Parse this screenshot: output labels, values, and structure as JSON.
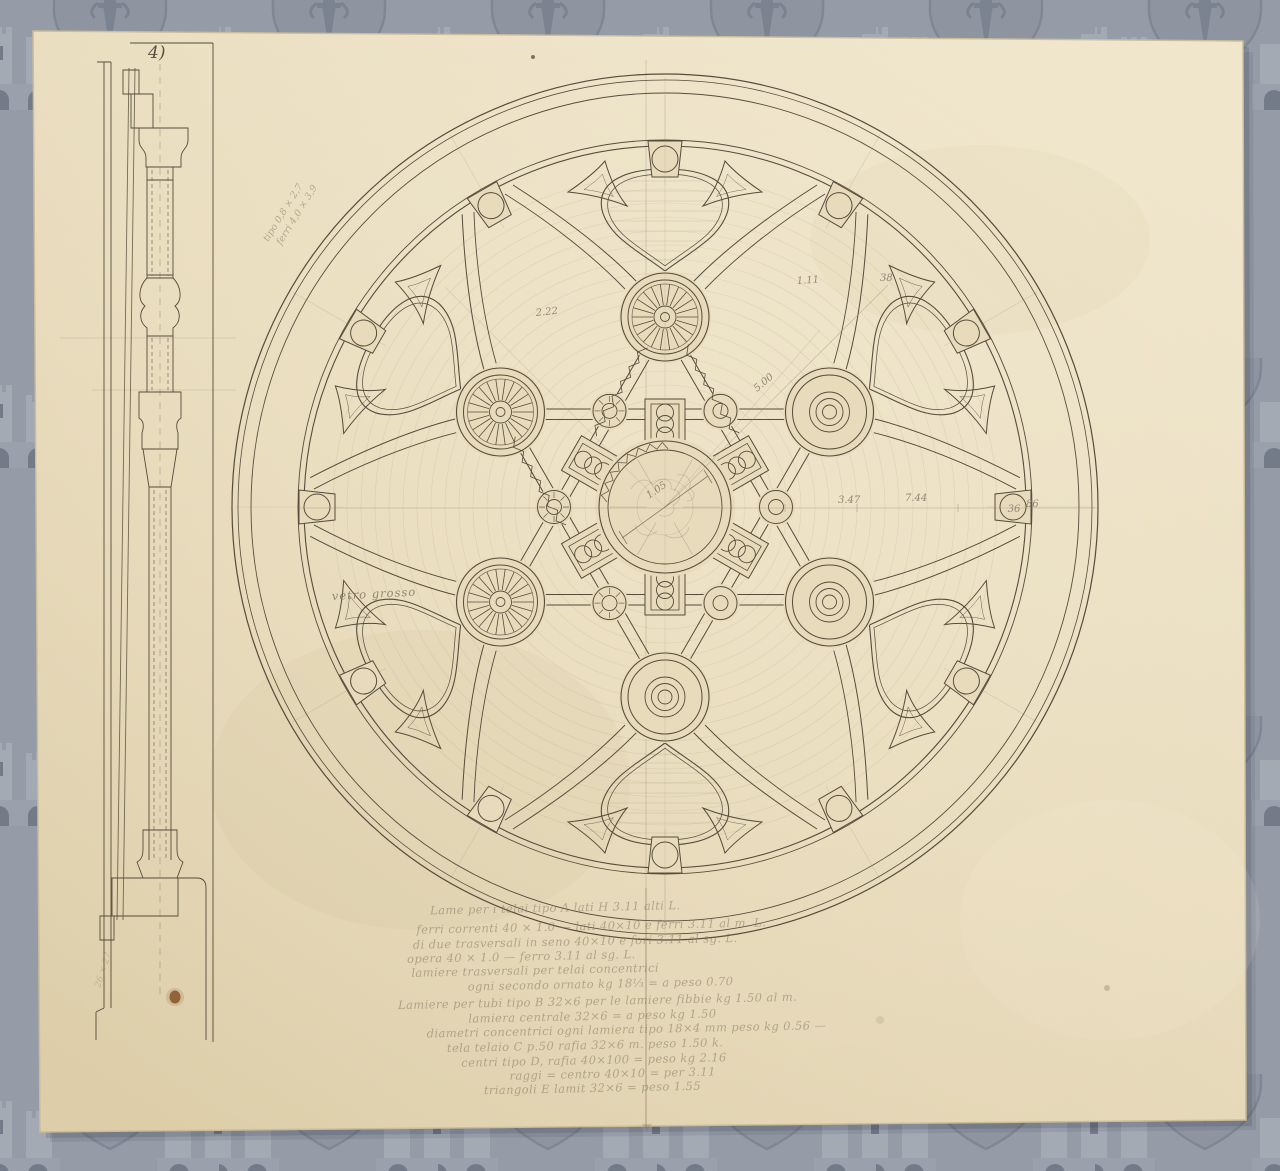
{
  "page": {
    "background_color": "#959ca7",
    "paper_color": "#e8dbbc",
    "ink_color": "#554c3c",
    "pencil_color": "#8c8172",
    "stain_color": "#8a5a2c",
    "watermark_icon": "heraldic-shield-castle-dagger-watermark-icon"
  },
  "sheet": {
    "number_label": "4)"
  },
  "annotations": {
    "dim_2_22": "2.22",
    "dim_1_11": "1.11",
    "dim_38": "38",
    "dim_5_00": "5.00",
    "dim_3_47": "3.47",
    "dim_7_44": "7.44",
    "dim_36": "36",
    "dim_86": "86",
    "dim_1_05": "1.05",
    "glass_note": "vetro grosso",
    "diag_note_line1": "tipo 0,8 × 2,7",
    "diag_note_line2": "ferri 4,0 × 3,9",
    "corner_note": "26 × 27"
  },
  "notes": {
    "lines": [
      "Lame per i telai tipo  A    lati H 3.11 alti L.",
      "ferri correnti 40 × 1.0 — lati 40×10 e ferri 3.11 al m. L.",
      "di due trasversali in seno 40×10 e fori 3.11 al sg. L.",
      "opera 40 × 1.0 — ferro 3.11 al sg. L.",
      "lamiere trasversali per telai concentrici",
      "ogni secondo ornato kg 18⅓ = a peso 0.70",
      "Lamiere per tubi tipo B 32×6 per le lamiere fibbie kg 1.50 al m.",
      "lamiera centrale 32×6 = a peso kg 1.50",
      "diametri concentrici ogni lamiera tipo 18×4 mm peso kg 0.56 —",
      "tela telaio C p.50 rafia 32×6 m. peso 1.50 k.",
      "centri tipo D, rafia 40×100 = peso kg 2.16",
      "raggi = centro 40×10 = per 3.11",
      "triangoli E lamit 32×6 = peso 1.55"
    ]
  }
}
